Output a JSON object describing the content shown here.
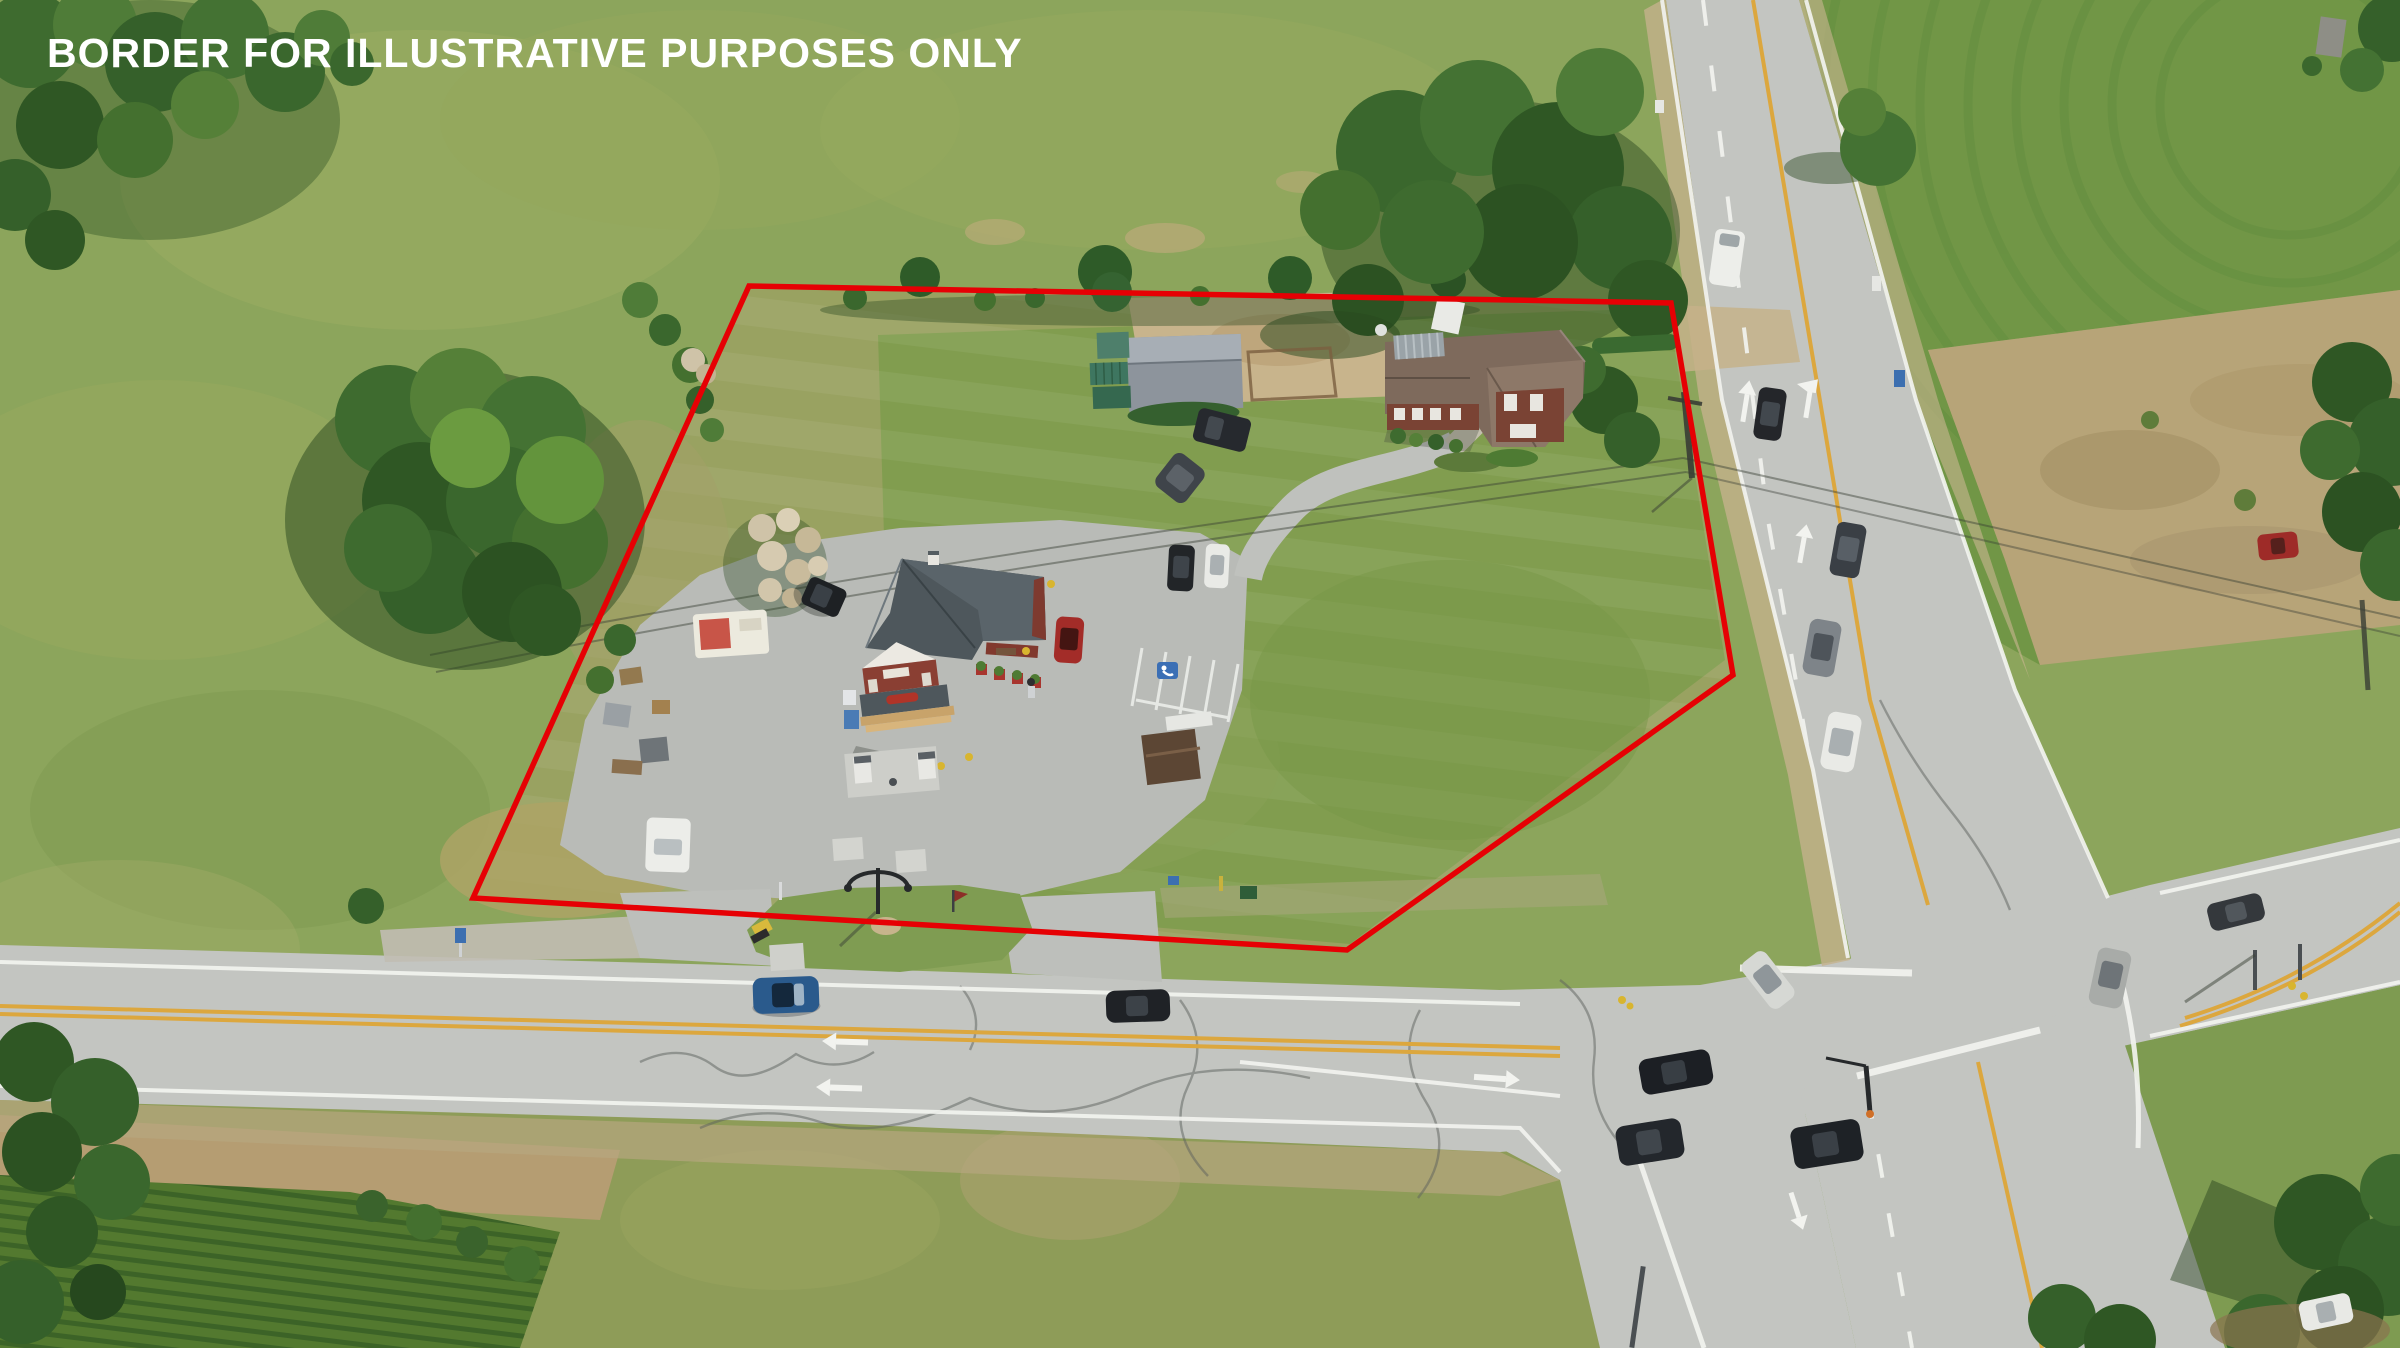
{
  "watermark": {
    "text": "BORDER FOR ILLUSTRATIVE PURPOSES ONLY",
    "color": "#ffffff"
  },
  "border": {
    "color": "#e60004",
    "width": "5.5"
  },
  "palette": {
    "pasture": "#8ca55c",
    "property_lawn_west": "#99a261",
    "property_lawn_east": "#7f9c4e",
    "mowed_lawn_ne": "#719646",
    "rough_field_tan": "#b7a478",
    "asphalt_road": "#c3c5c1",
    "asphalt_lot": "#b9bbb7",
    "gravel": "#c9b58f",
    "corn_field": "#53792f",
    "yellow_line": "#dca73e",
    "white_line": "#f2f3ef",
    "store_roof": "#4e575c",
    "house_roof": "#7e6a5c",
    "barn_roof": "#8d949c",
    "brick": "#7a4334",
    "tree_dark": "#2f5724",
    "tree_mid": "#3e6b2f",
    "tree_light": "#558038"
  },
  "landmarks": {
    "property_border": "red-outlined parcel",
    "country_store": "gable-front store with porch and gas pumps",
    "farmhouse": "brick house with cross-gable roof",
    "barn": "gray barn with green shipping containers",
    "grass_median_island": "entrance island with double lamppost",
    "intersection": "four-way rural highway intersection",
    "corn_field": "row-crop field bottom-left"
  }
}
